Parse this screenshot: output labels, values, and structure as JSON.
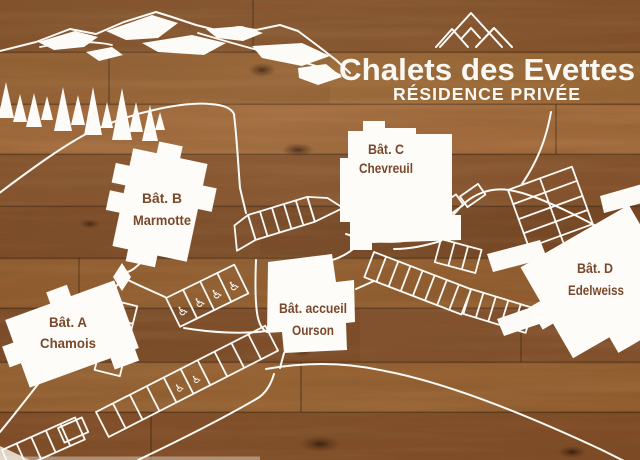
{
  "sign": {
    "title": "Chalets des Evettes",
    "subtitle": "RÉSIDENCE PRIVÉE"
  },
  "buildings": [
    {
      "name": "Bât. A",
      "subname": "Chamois"
    },
    {
      "name": "Bât. B",
      "subname": "Marmotte"
    },
    {
      "name": "Bât. C",
      "subname": "Chevreuil"
    },
    {
      "name": "Bât. accueil",
      "subname": "Ourson"
    },
    {
      "name": "Bât. D",
      "subname": "Edelweiss"
    }
  ],
  "icons": {
    "accessible_parking": "♿",
    "mountain_logo": "three-mountain-peaks",
    "trees": "fir-trees",
    "marker": "kite-junction-marker"
  },
  "colors": {
    "wood_brown": "#8a5429",
    "map_line_white": "#fbfaf6",
    "label_brown": "#7a482a"
  }
}
